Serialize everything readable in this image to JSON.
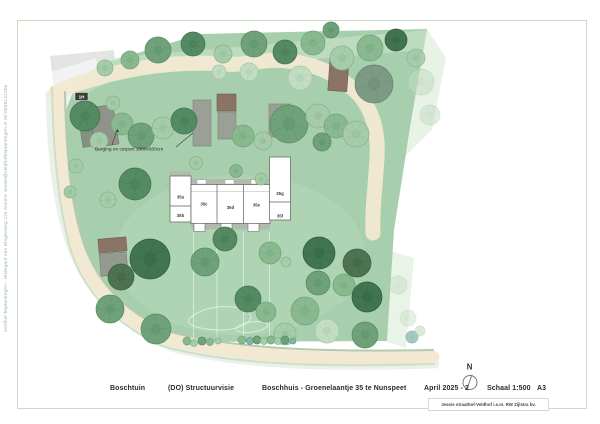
{
  "page": {
    "side_text": "Veldhof beplantingen - Hildegard van Bingenweg 220 Almere   Jessie@veldhofbeplantingen.nl   tel:0636141256"
  },
  "plan": {
    "badge": "1H",
    "annotation": "Berging en carport 1000x600cm",
    "north_label": "N",
    "units": [
      {
        "label": "35a"
      },
      {
        "label": "35b"
      },
      {
        "label": "35c"
      },
      {
        "label": "35d"
      },
      {
        "label": "35e"
      },
      {
        "label": "35f"
      },
      {
        "label": "35g"
      }
    ],
    "colors": {
      "site_green": "#a7cfad",
      "lawn_light": "#b8dabc",
      "path_beige": "#f2e9d2",
      "road_stripe": "#b5c9af",
      "building_white": "#ffffff",
      "shed_gray": "#9aa096",
      "shed_brown": "#8b7365",
      "frame": "#cbdcc5"
    }
  },
  "titlebar": {
    "project": "Boschtuin",
    "phase": "(DO) Structuurvisie",
    "address": "Boschhuis - Groenelaantje 35 te Nunspeet",
    "date": "April 2025 - 2",
    "scale": "Schaal 1:500",
    "sheet": "A3",
    "credit": "Jessie straathof-Veldhof i.s.m. RW Zijlstra bv."
  }
}
